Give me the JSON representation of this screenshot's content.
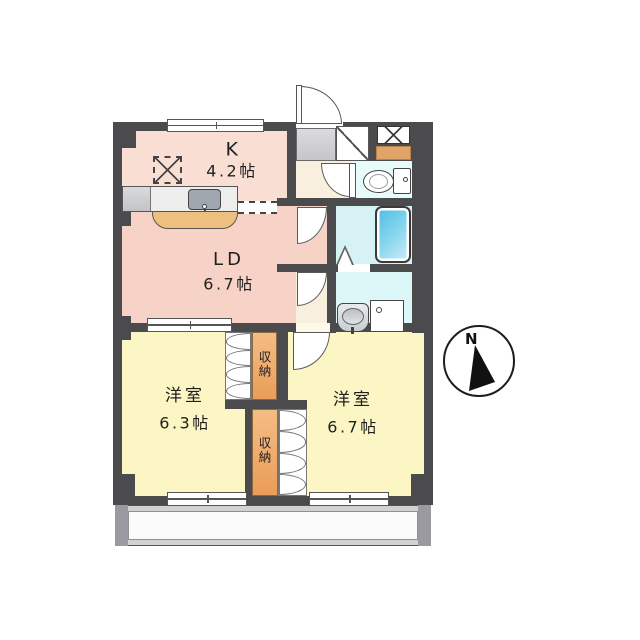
{
  "compass": {
    "label": "N"
  },
  "rooms": {
    "kitchen": {
      "label": "K",
      "size": "4.2帖"
    },
    "living_dining": {
      "label": "LD",
      "size": "6.7帖"
    },
    "bedroom_left": {
      "label": "洋室",
      "size": "6.3帖"
    },
    "bedroom_right": {
      "label": "洋室",
      "size": "6.7帖"
    },
    "closet_top": {
      "label": "収\n納"
    },
    "closet_bottom": {
      "label": "収\n納"
    }
  },
  "colors": {
    "wall": "#4b4b4e",
    "kitchen_floor": "#f9ded3",
    "living_floor": "#f6d3c6",
    "bedroom_floor": "#fbf6c3",
    "closet_fill": "#efae6e",
    "hall_floor": "#f8f0dc",
    "entrance_step": "#cfcfd4",
    "toilet_floor": "#e7fbfa",
    "bath_floor": "#d7f2f5",
    "washroom_floor": "#dcf7f7",
    "bathtub": "#5ec6e7",
    "shoe_shelf_strip": "#e2a368",
    "balcony": "#d2d2d2"
  }
}
